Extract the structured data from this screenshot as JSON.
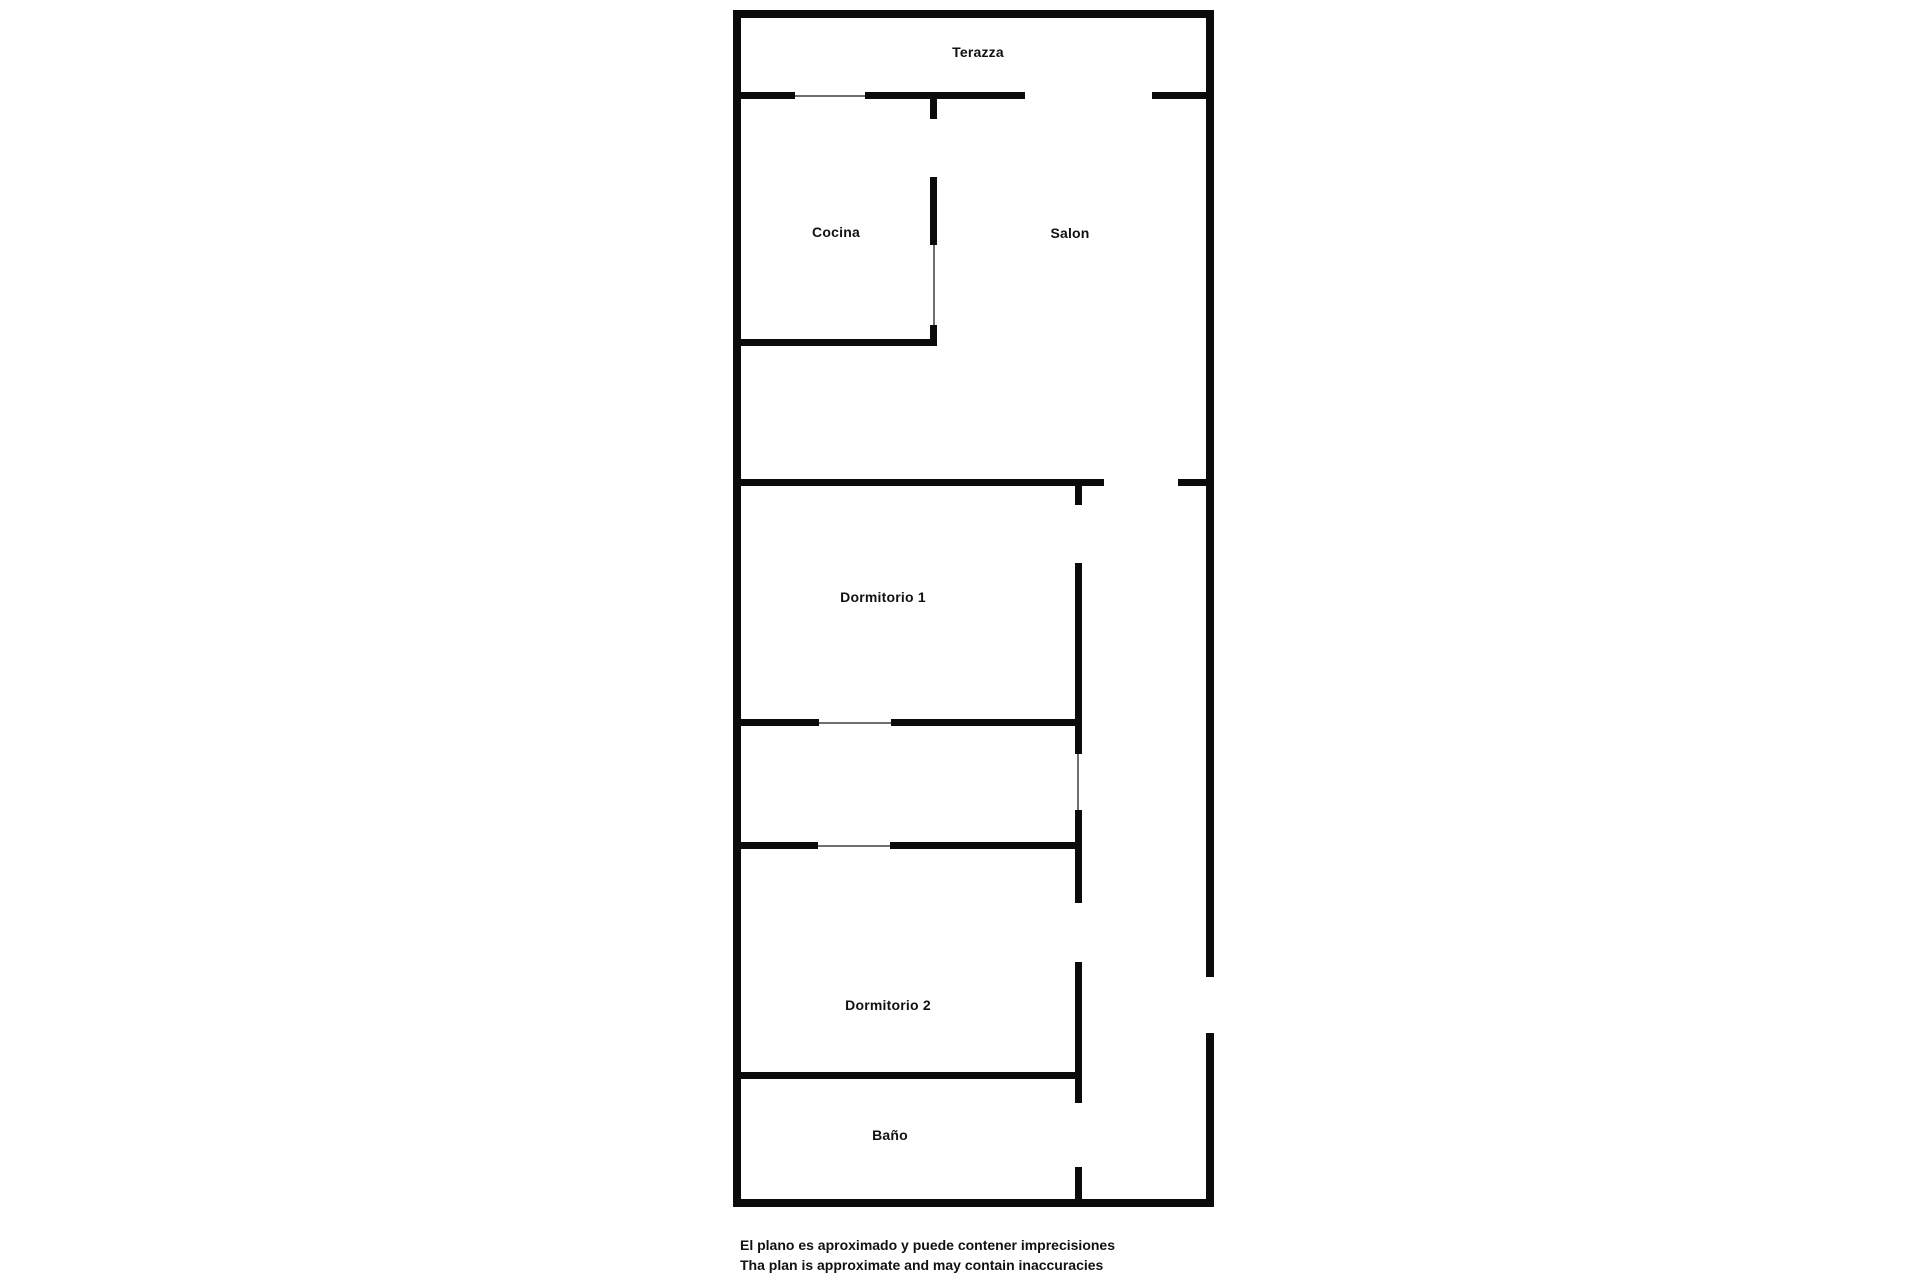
{
  "page": {
    "background": "#ffffff"
  },
  "plan": {
    "wall_color": "#0b0b0b",
    "thin_color": "#6f6f6f",
    "label_color": "#111111",
    "walls": [
      {
        "x": 733,
        "y": 10,
        "w": 481,
        "h": 8
      },
      {
        "x": 733,
        "y": 10,
        "w": 8,
        "h": 1197
      },
      {
        "x": 1206,
        "y": 10,
        "w": 8,
        "h": 967
      },
      {
        "x": 1206,
        "y": 1033,
        "w": 8,
        "h": 174
      },
      {
        "x": 733,
        "y": 1199,
        "w": 481,
        "h": 8
      },
      {
        "x": 737,
        "y": 92,
        "w": 58,
        "h": 7
      },
      {
        "x": 795,
        "y": 95,
        "w": 72,
        "h": 2,
        "thin": true
      },
      {
        "x": 865,
        "y": 92,
        "w": 160,
        "h": 7
      },
      {
        "x": 1152,
        "y": 92,
        "w": 56,
        "h": 7
      },
      {
        "x": 930,
        "y": 92,
        "w": 7,
        "h": 27
      },
      {
        "x": 930,
        "y": 177,
        "w": 7,
        "h": 68
      },
      {
        "x": 933,
        "y": 245,
        "w": 2,
        "h": 80,
        "thin": true
      },
      {
        "x": 930,
        "y": 325,
        "w": 7,
        "h": 21
      },
      {
        "x": 737,
        "y": 339,
        "w": 200,
        "h": 7
      },
      {
        "x": 737,
        "y": 479,
        "w": 367,
        "h": 7
      },
      {
        "x": 1178,
        "y": 479,
        "w": 30,
        "h": 7
      },
      {
        "x": 1075,
        "y": 479,
        "w": 7,
        "h": 26
      },
      {
        "x": 1075,
        "y": 563,
        "w": 7,
        "h": 191
      },
      {
        "x": 1077,
        "y": 754,
        "w": 2,
        "h": 56,
        "thin": true
      },
      {
        "x": 1075,
        "y": 810,
        "w": 7,
        "h": 93
      },
      {
        "x": 1075,
        "y": 962,
        "w": 7,
        "h": 141
      },
      {
        "x": 1075,
        "y": 1167,
        "w": 7,
        "h": 40
      },
      {
        "x": 737,
        "y": 719,
        "w": 82,
        "h": 7
      },
      {
        "x": 819,
        "y": 722,
        "w": 72,
        "h": 2,
        "thin": true
      },
      {
        "x": 891,
        "y": 719,
        "w": 191,
        "h": 7
      },
      {
        "x": 737,
        "y": 842,
        "w": 81,
        "h": 7
      },
      {
        "x": 818,
        "y": 845,
        "w": 72,
        "h": 2,
        "thin": true
      },
      {
        "x": 890,
        "y": 842,
        "w": 192,
        "h": 7
      },
      {
        "x": 737,
        "y": 1072,
        "w": 345,
        "h": 7
      }
    ],
    "rooms": [
      {
        "id": "terazza",
        "label": "Terazza",
        "x": 978,
        "y": 52
      },
      {
        "id": "cocina",
        "label": "Cocina",
        "x": 836,
        "y": 232
      },
      {
        "id": "salon",
        "label": "Salon",
        "x": 1070,
        "y": 233
      },
      {
        "id": "dormitorio-1",
        "label": "Dormitorio 1",
        "x": 883,
        "y": 597
      },
      {
        "id": "dormitorio-2",
        "label": "Dormitorio 2",
        "x": 888,
        "y": 1005
      },
      {
        "id": "bano",
        "label": "Baño",
        "x": 890,
        "y": 1135
      }
    ]
  },
  "disclaimer": {
    "line1": "El plano es aproximado y puede contener imprecisiones",
    "line2": "Tha plan is approximate and may contain inaccuracies"
  }
}
